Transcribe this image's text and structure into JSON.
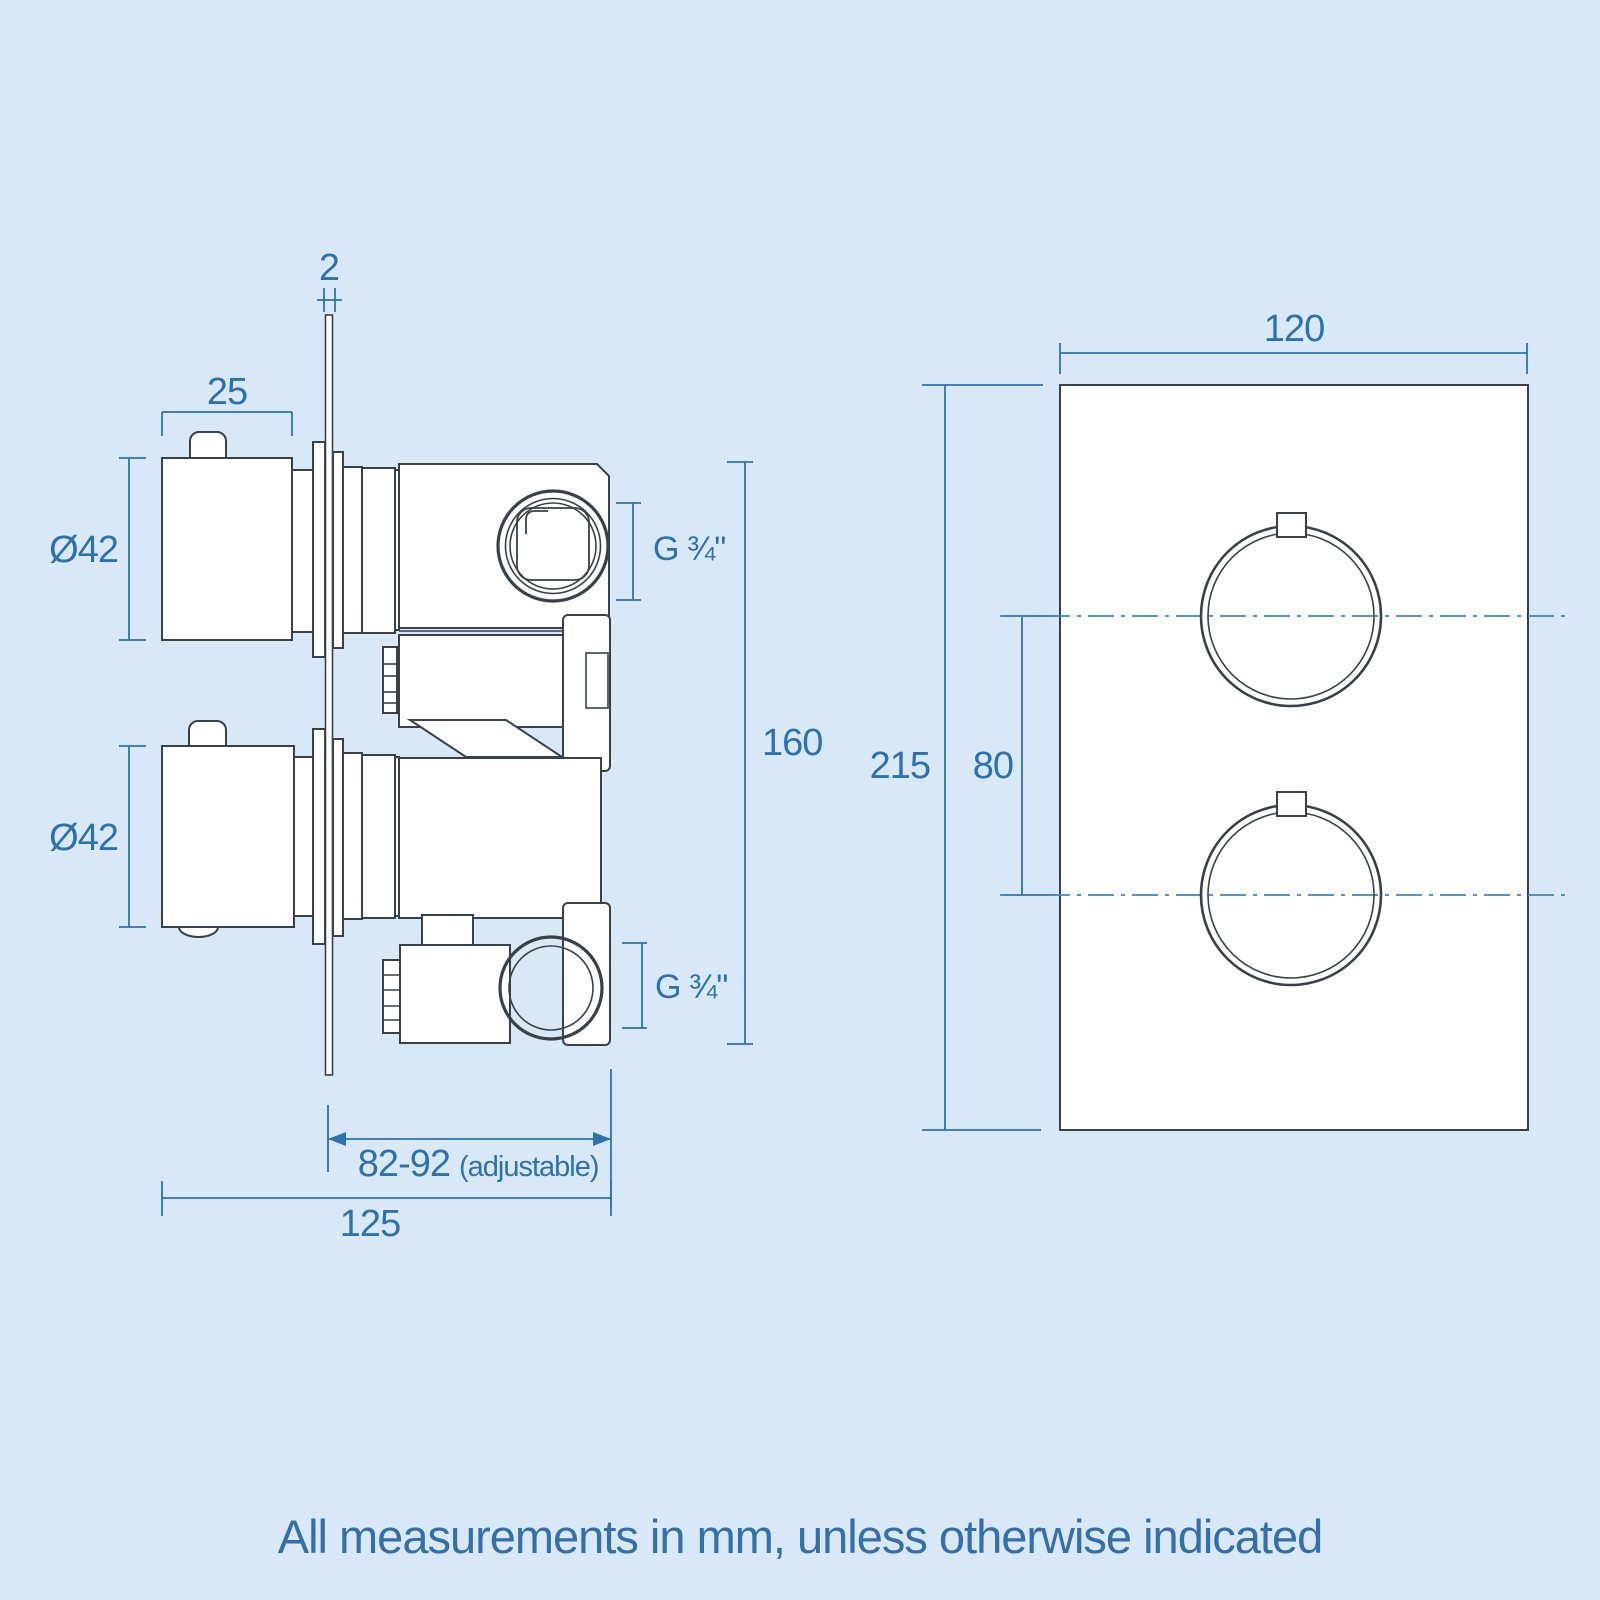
{
  "page": {
    "background": "#d9e8f6",
    "footer_note": "All measurements in mm, unless otherwise indicated"
  },
  "colors": {
    "dimension_blue": "#2d72ad",
    "centerline_blue": "#3f82c4",
    "drawing_line": "#3a4047",
    "part_fill": "#ffffff"
  },
  "side_view": {
    "labels": {
      "plate_thickness": "2",
      "knob_depth": "25",
      "upper_knob_diameter": "Ø42",
      "lower_knob_diameter": "Ø42",
      "upper_port_thread": "G ¾\"",
      "lower_port_thread": "G ¾\"",
      "body_height": "160",
      "recess_depth_range": "82-92",
      "recess_depth_note": "(adjustable)",
      "overall_depth": "125"
    }
  },
  "front_view": {
    "labels": {
      "plate_width": "120",
      "plate_height": "215",
      "handle_centres": "80"
    }
  }
}
